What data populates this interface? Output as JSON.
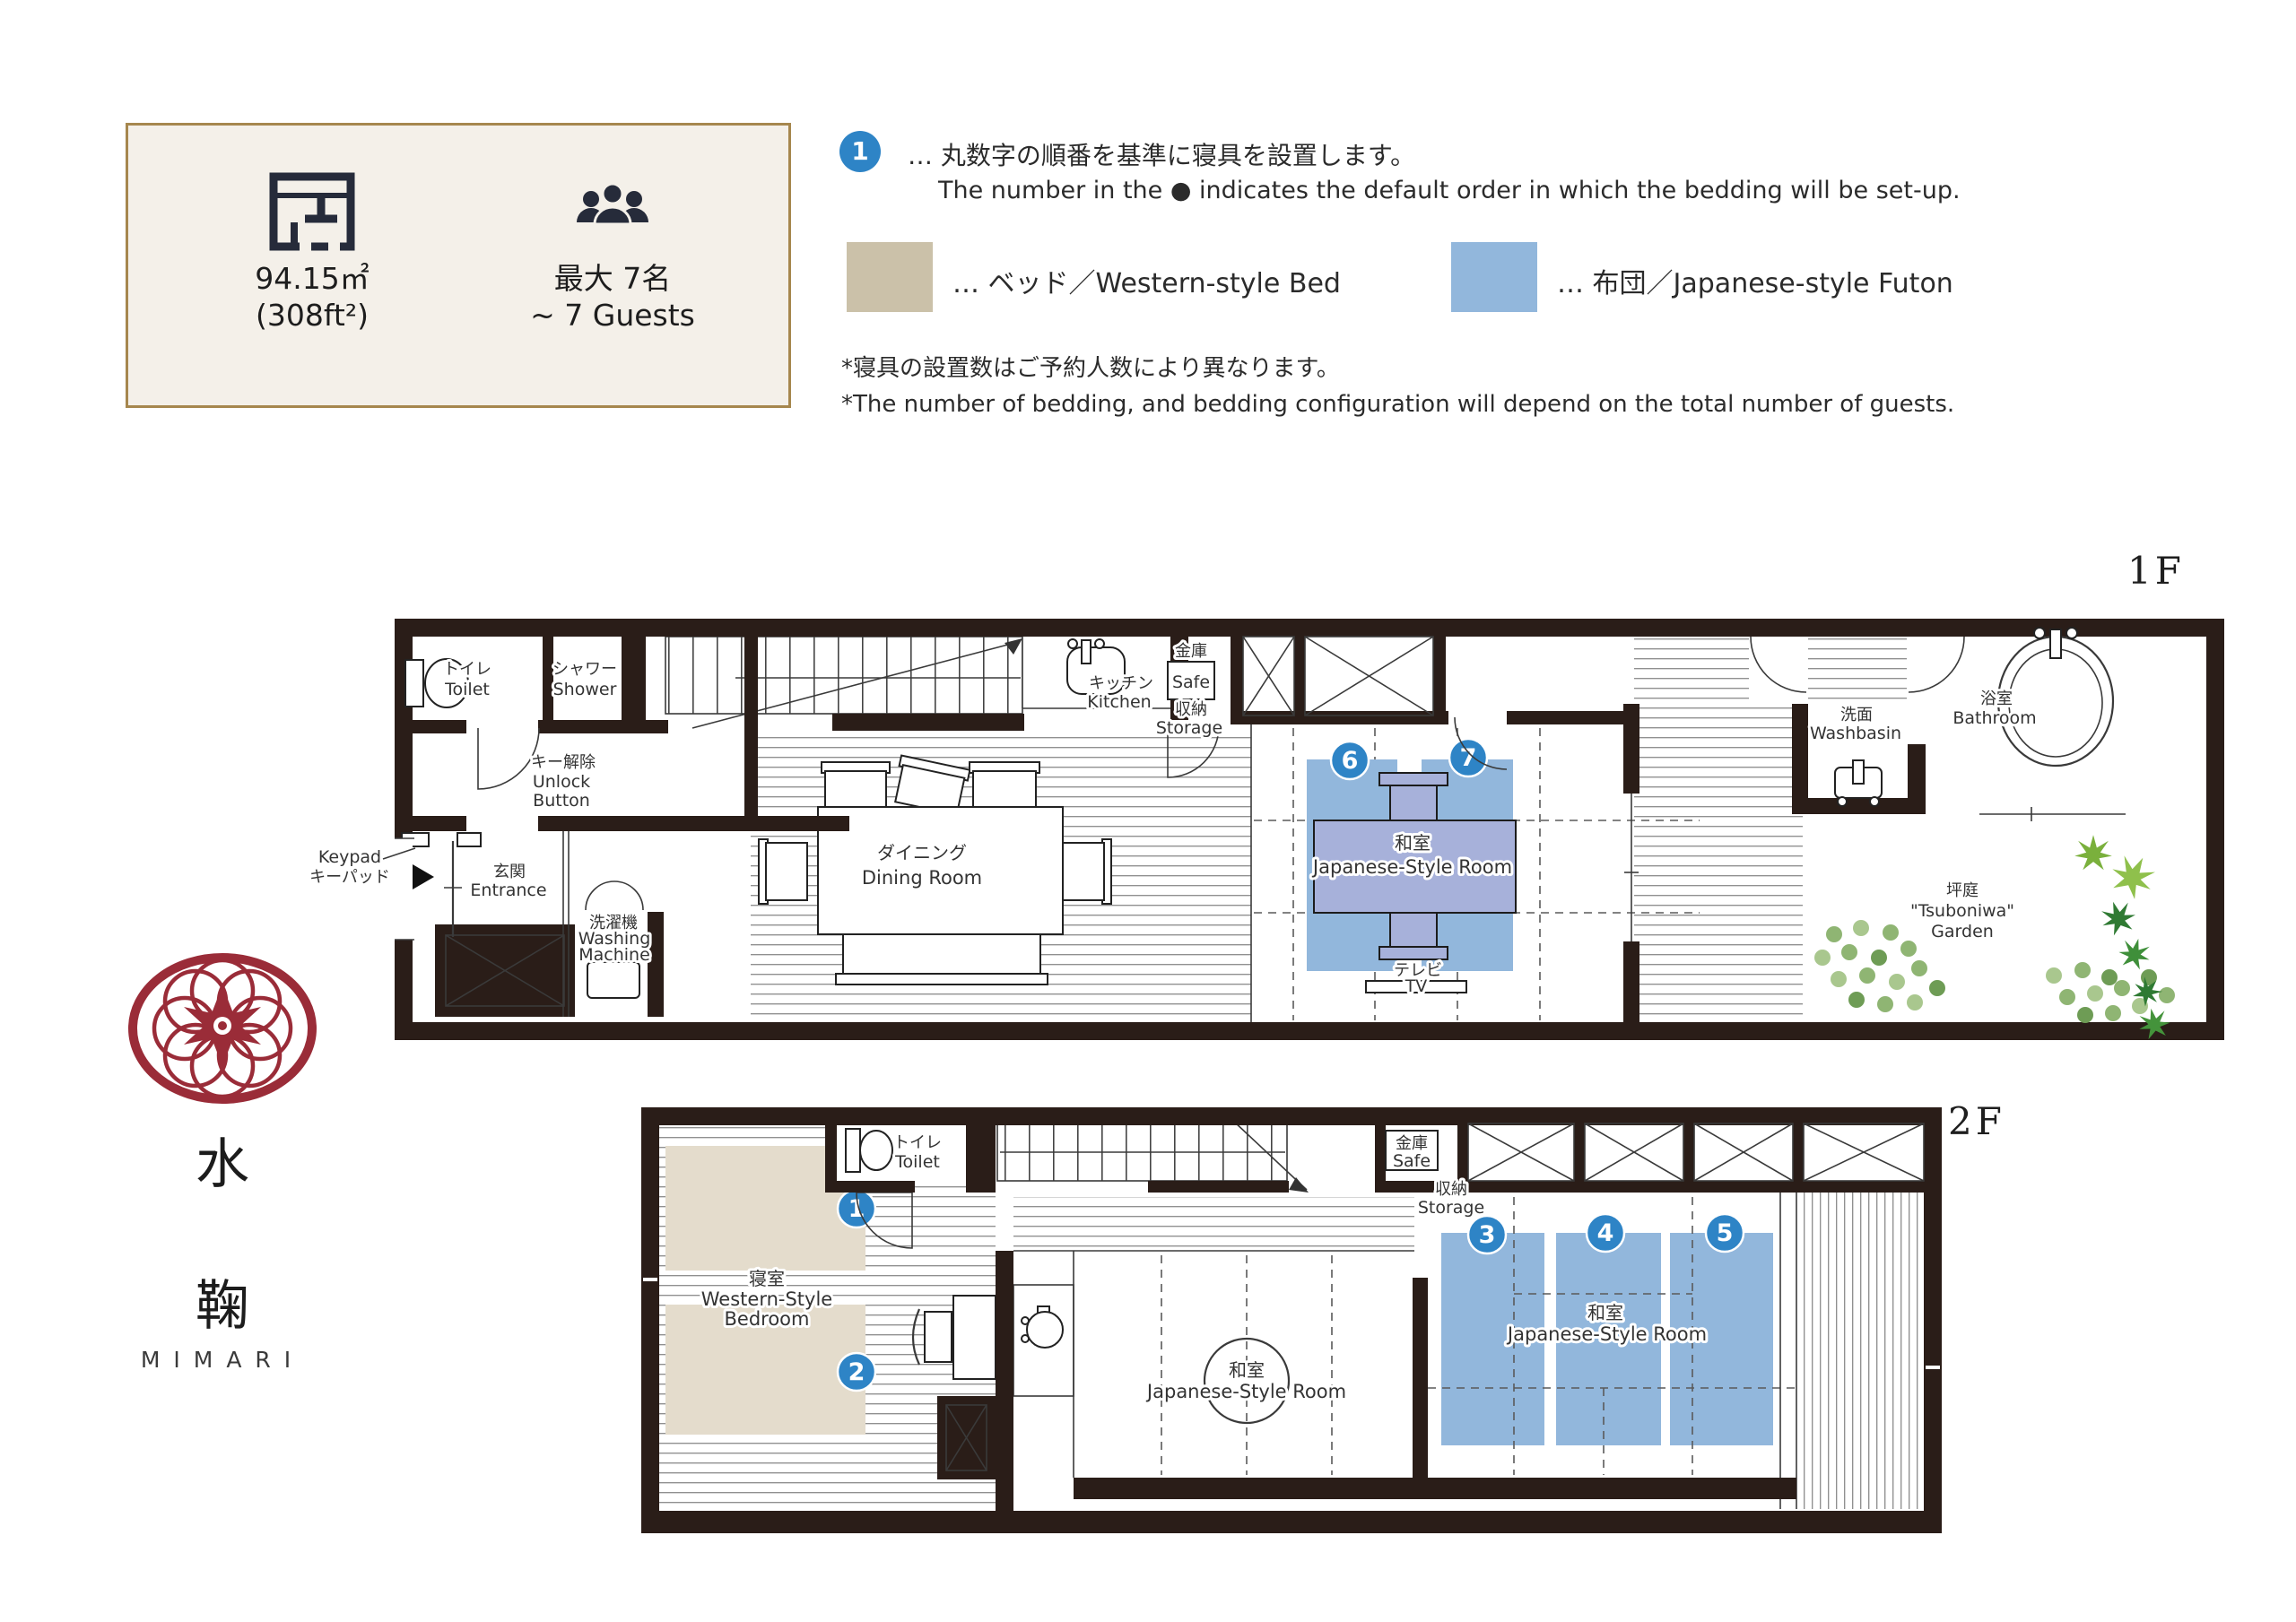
{
  "info_box": {
    "area_m2": "94.15㎡",
    "area_ft2": "(308ft²)",
    "capacity_ja": "最大 7名",
    "capacity_en": "~ 7 Guests"
  },
  "legend": {
    "order_circle_number": "1",
    "order_note_ja": "… 丸数字の順番を基準に寝具を設置します。",
    "order_note_en": "The number in the ● indicates the default order in which the bedding will be set-up.",
    "bed_swatch_label": "… ベッド／Western-style Bed",
    "futon_swatch_label": "… 布団／Japanese-style Futon",
    "footnote_ja": "*寝具の設置数はご予約人数により異なります。",
    "footnote_en": "*The number of bedding, and bedding configuration will depend on the total number of guests.",
    "colors": {
      "bed": "#CBC1A9",
      "futon": "#92B7DC",
      "order_circle": "#2E84C6",
      "wall": "#2A1D18",
      "logo_red": "#9A2C38"
    }
  },
  "floors": {
    "floor1_label": "1F",
    "floor2_label": "2F"
  },
  "rooms": {
    "toilet_ja": "トイレ",
    "toilet_en": "Toilet",
    "shower_ja": "シャワー",
    "shower_en": "Shower",
    "unlock_ja": "キー解除",
    "unlock_en_line1": "Unlock",
    "unlock_en_line2": "Button",
    "keypad_en": "Keypad",
    "keypad_ja": "キーパッド",
    "entrance_ja": "玄関",
    "entrance_en": "Entrance",
    "washing_machine_ja": "洗濯機",
    "washing_machine_en_line1": "Washing",
    "washing_machine_en_line2": "Machine",
    "dining_ja": "ダイニング",
    "dining_en": "Dining Room",
    "kitchen_ja": "キッチン",
    "kitchen_en": "Kitchen",
    "safe_ja": "金庫",
    "safe_en": "Safe",
    "storage_ja": "収納",
    "storage_en": "Storage",
    "japanese_room_ja": "和室",
    "japanese_room_en": "Japanese-Style Room",
    "tv_ja": "テレビ",
    "tv_en": "TV",
    "washbasin_ja": "洗面",
    "washbasin_en": "Washbasin",
    "bathroom_ja": "浴室",
    "bathroom_en": "Bathroom",
    "garden_ja": "坪庭",
    "garden_en_line1": "\"Tsuboniwa\"",
    "garden_en_line2": "Garden",
    "bedroom_ja": "寝室",
    "bedroom_en_line1": "Western-Style",
    "bedroom_en_line2": "Bedroom"
  },
  "bedding": {
    "numbers": [
      "1",
      "2",
      "3",
      "4",
      "5",
      "6",
      "7"
    ]
  },
  "logo": {
    "kanji_1": "水",
    "kanji_2": "鞠",
    "latin": "MIMARI"
  }
}
